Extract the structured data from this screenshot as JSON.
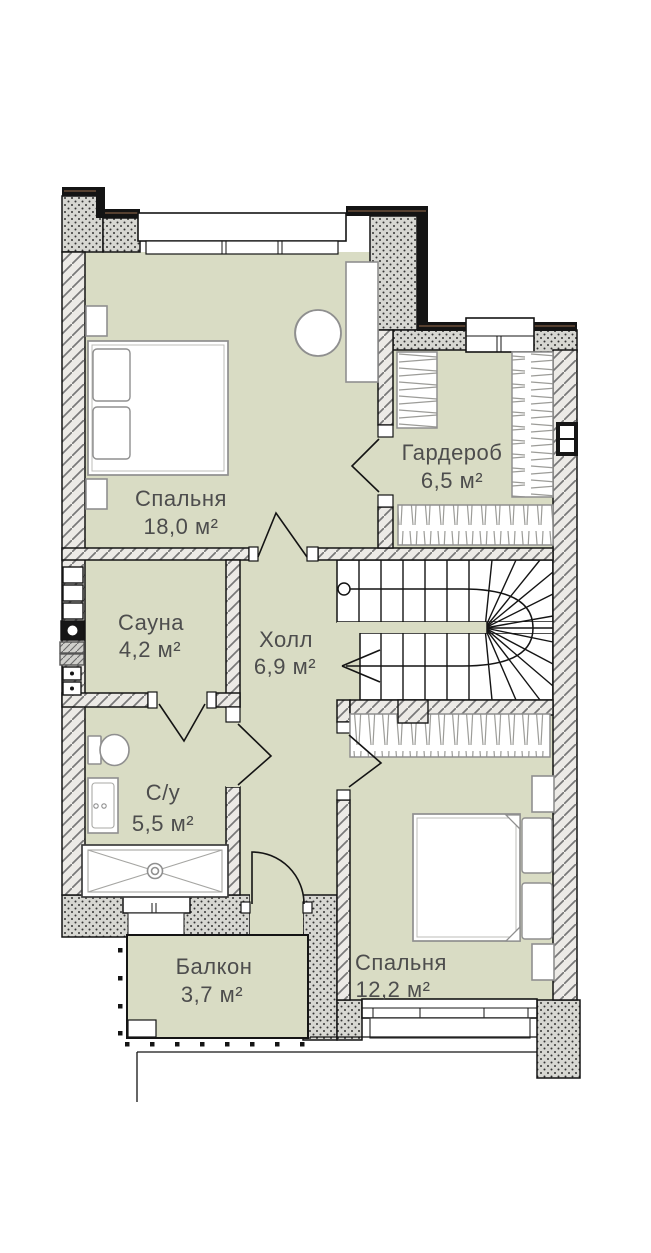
{
  "plan": {
    "rooms": [
      {
        "name": "Спальня",
        "area": "18,0 м²"
      },
      {
        "name": "Гардероб",
        "area": "6,5 м²"
      },
      {
        "name": "Сауна",
        "area": "4,2 м²"
      },
      {
        "name": "Холл",
        "area": "6,9 м²"
      },
      {
        "name": "С/у",
        "area": "5,5 м²"
      },
      {
        "name": "Балкон",
        "area": "3,7 м²"
      },
      {
        "name": "Спальня",
        "area": "12,2 м²"
      }
    ],
    "colors": {
      "floor_fill": "#d9dcc4",
      "exterior_wall_dotted_bg": "#d7d7d2",
      "interior_wall_hatch_bg": "#eceae6",
      "outline": "#141414",
      "furniture_stroke": "#8f8f8f",
      "label_text": "#4d4d4d",
      "facade_band_accent": "#7d5b40"
    }
  }
}
